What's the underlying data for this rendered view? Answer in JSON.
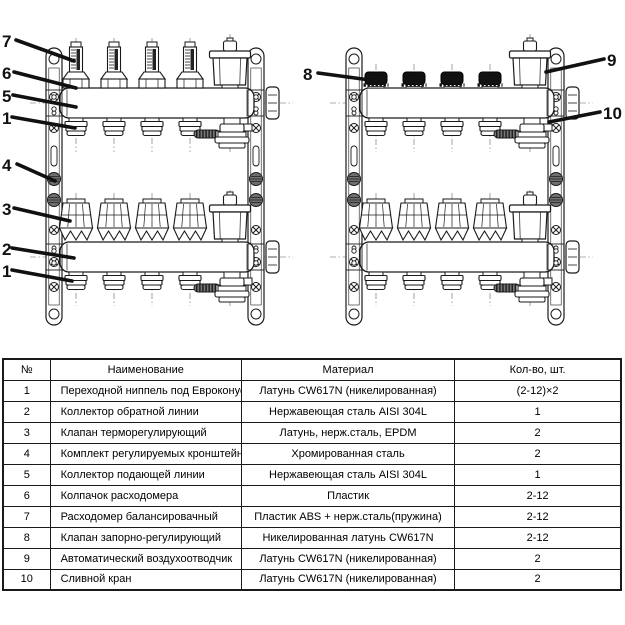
{
  "page": {
    "background": "#ffffff"
  },
  "colors": {
    "line": "#1a1a1a",
    "black_cap": "#111111",
    "knurl_nut": "#6f6f6f",
    "drain_wheel": "#777777"
  },
  "diagrams": {
    "left": {
      "callouts": [
        "7",
        "6",
        "5",
        "1",
        "4",
        "3",
        "2",
        "1"
      ]
    },
    "right": {
      "callouts": [
        "8",
        "9",
        "10"
      ]
    }
  },
  "table": {
    "headers": [
      "№",
      "Наименование",
      "Материал",
      "Кол-во, шт."
    ],
    "rows": [
      [
        "1",
        "Переходной ниппель под Евроконус",
        "Латунь CW617N (никелированная)",
        "(2-12)×2"
      ],
      [
        "2",
        "Коллектор обратной линии",
        "Нержавеющая сталь AISI 304L",
        "1"
      ],
      [
        "3",
        "Клапан терморегулирующий",
        "Латунь, нерж.сталь, EPDM",
        "2"
      ],
      [
        "4",
        "Комплект регулируемых кронштейнов",
        "Хромированная сталь",
        "2"
      ],
      [
        "5",
        "Коллектор подающей линии",
        "Нержавеющая сталь AISI 304L",
        "1"
      ],
      [
        "6",
        "Колпачок расходомера",
        "Пластик",
        "2-12"
      ],
      [
        "7",
        "Расходомер балансировачный",
        "Пластик ABS + нерж.сталь(пружина)",
        "2-12"
      ],
      [
        "8",
        "Клапан запорно-регулирующий",
        "Никелированная латунь CW617N",
        "2-12"
      ],
      [
        "9",
        "Автоматический воздухоотводчик",
        "Латунь CW617N (никелированная)",
        "2"
      ],
      [
        "10",
        "Сливной кран",
        "Латунь CW617N (никелированная)",
        "2"
      ]
    ]
  }
}
